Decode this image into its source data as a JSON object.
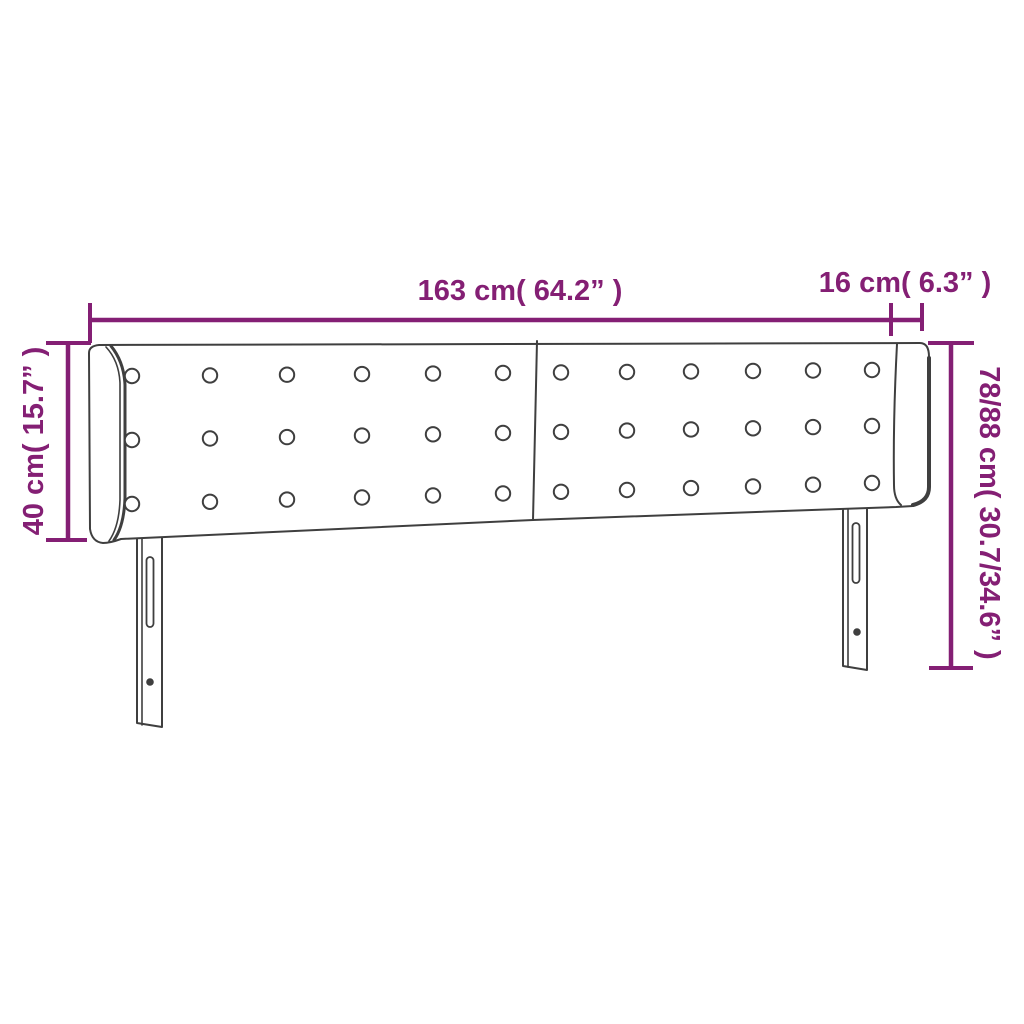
{
  "figure": {
    "title": "Headboard dimension diagram",
    "labels": {
      "width": "163 cm( 64.2” )",
      "depth": "16 cm( 6.3” )",
      "height_front": "40 cm( 15.7” )",
      "height_total": "78/88 cm( 30.7/34.6” )"
    },
    "colors": {
      "dimension": "#841f74",
      "line_art": "#3f3f3f",
      "background": "#ffffff"
    }
  }
}
